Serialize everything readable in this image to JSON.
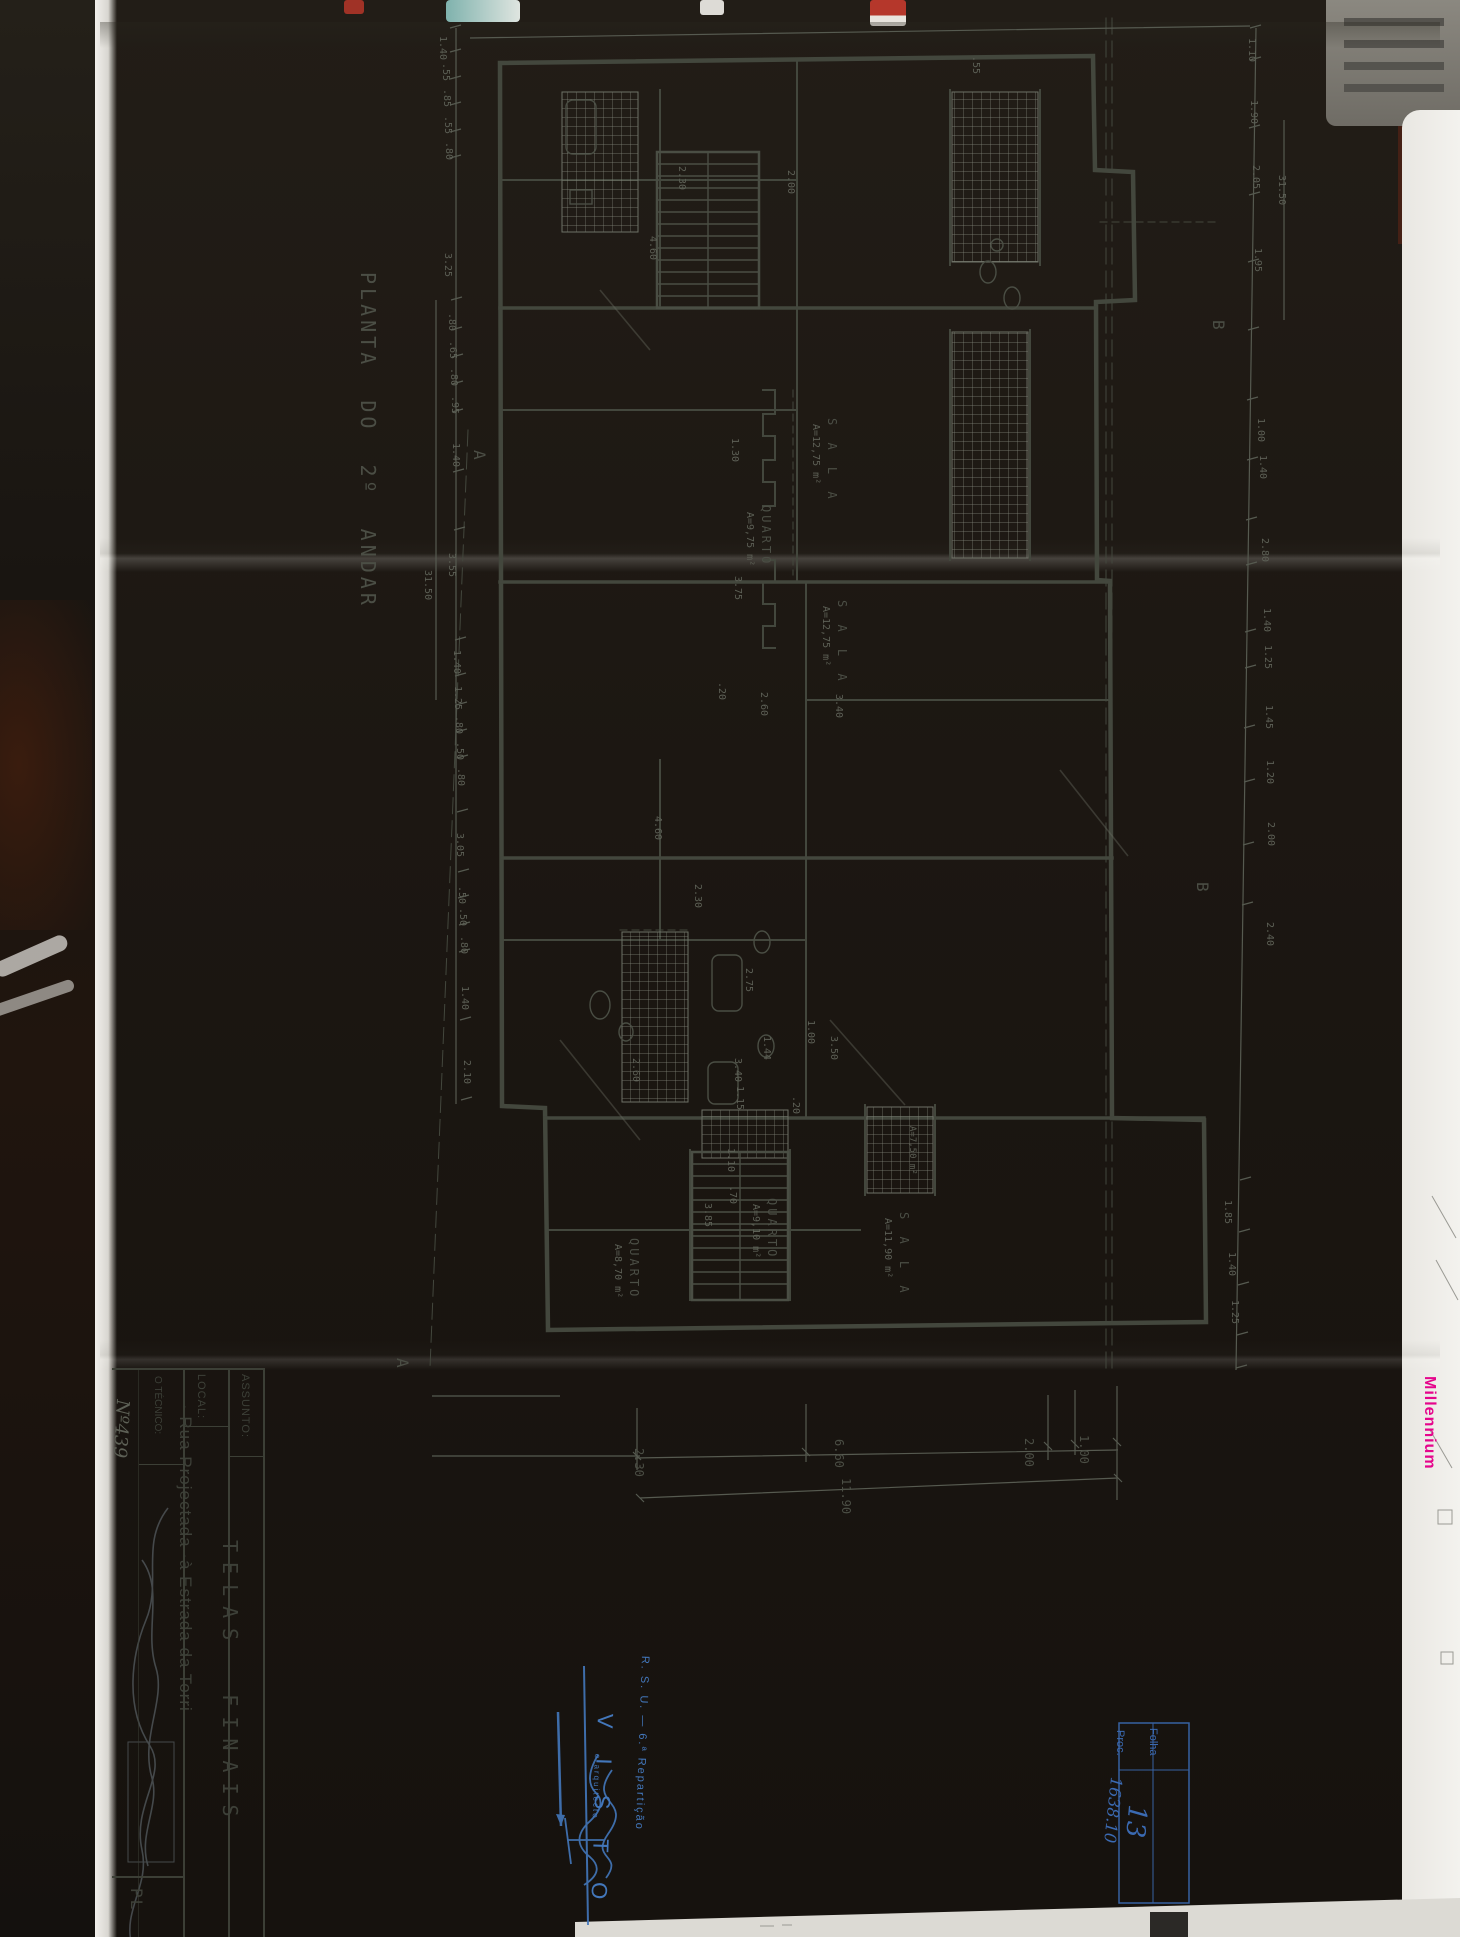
{
  "photo": {
    "description": "photograph of folded blueprint on dark table"
  },
  "drawing": {
    "title": "PLANTA  DO  2º  ANDAR",
    "sheet_subject": "TELAS FINAIS",
    "location": "Rua Projectada à Estrada da Torri",
    "floor_total_dim": "31.50"
  },
  "title_block": {
    "assunto_label": "ASSUNTO:",
    "assunto_value": "T E L A S   F I N A I S",
    "local_label": "LOCAL:",
    "local_value": "Rua Projectada ·à Estrada da Torri",
    "tecnico_label": "O TÉCNICO:",
    "tecnico_number": "Nº439",
    "corner_label": "PL"
  },
  "visto_stamp": {
    "dept": "R. S. U. — 6.ª Repartição",
    "visto": "V I S T O",
    "signer": "o arquitecto"
  },
  "folha_box": {
    "folha_label": "Folha",
    "folha_value": "13",
    "proc_label": "Proc.",
    "proc_value": "1638.10"
  },
  "side_text": {
    "brand": "Millennium"
  },
  "colors": {
    "paper": "#b3b0a4",
    "pencil": "#4b4e45",
    "wall": "#3d4038",
    "stamp_blue": "#4377bb",
    "brand_pink": "#e5058c"
  },
  "labels": [
    {
      "n": "drawing-title",
      "t": "PLANTA  DO  2º  ANDAR",
      "x": 378,
      "y": 272,
      "s": 20,
      "ls": 4,
      "c": "pencil"
    },
    {
      "n": "section-mark-a",
      "t": "A",
      "x": 487,
      "y": 450,
      "s": 16,
      "c": "pencil"
    },
    {
      "n": "section-mark-a",
      "t": "A",
      "x": 410,
      "y": 1358,
      "s": 16,
      "c": "pencil"
    },
    {
      "n": "section-mark-b",
      "t": "B",
      "x": 1226,
      "y": 320,
      "s": 16,
      "c": "pencil"
    },
    {
      "n": "section-mark-b",
      "t": "B",
      "x": 1210,
      "y": 882,
      "s": 16,
      "c": "pencil"
    },
    {
      "n": "room-name",
      "t": "S A L A",
      "x": 838,
      "y": 418,
      "s": 12,
      "ls": 5,
      "c": "pencil"
    },
    {
      "n": "room-area",
      "t": "A=12,75 m²",
      "x": 820,
      "y": 424,
      "s": 10,
      "c": "pencil2"
    },
    {
      "n": "room-name",
      "t": "QUARTO",
      "x": 772,
      "y": 505,
      "s": 12,
      "ls": 3,
      "c": "pencil"
    },
    {
      "n": "room-area",
      "t": "A=9,75 m²",
      "x": 754,
      "y": 512,
      "s": 10,
      "c": "pencil2"
    },
    {
      "n": "room-name",
      "t": "S A L A",
      "x": 848,
      "y": 600,
      "s": 12,
      "ls": 5,
      "c": "pencil"
    },
    {
      "n": "room-area",
      "t": "A=12,75 m²",
      "x": 830,
      "y": 606,
      "s": 10,
      "c": "pencil2"
    },
    {
      "n": "room-name",
      "t": "QUARTO",
      "x": 640,
      "y": 1238,
      "s": 12,
      "ls": 3,
      "c": "pencil"
    },
    {
      "n": "room-area",
      "t": "A=8,70 m²",
      "x": 622,
      "y": 1244,
      "s": 10,
      "c": "pencil2"
    },
    {
      "n": "room-name",
      "t": "QUARTO",
      "x": 778,
      "y": 1198,
      "s": 12,
      "ls": 3,
      "c": "pencil"
    },
    {
      "n": "room-area",
      "t": "A=9,10 m²",
      "x": 760,
      "y": 1204,
      "s": 10,
      "c": "pencil2"
    },
    {
      "n": "room-name",
      "t": "S A L A",
      "x": 910,
      "y": 1212,
      "s": 12,
      "ls": 5,
      "c": "pencil"
    },
    {
      "n": "room-area",
      "t": "A=11,90 m²",
      "x": 892,
      "y": 1218,
      "s": 10,
      "c": "pencil2"
    },
    {
      "n": "room-area",
      "t": "A=7,50 m²",
      "x": 916,
      "y": 1126,
      "s": 9,
      "c": "pencil2"
    },
    {
      "n": "dimension-label",
      "t": "1.40",
      "x": 447,
      "y": 36,
      "c": "pencil2"
    },
    {
      "n": "dimension-label",
      "t": ".55",
      "x": 450,
      "y": 63,
      "c": "pencil2"
    },
    {
      "n": "dimension-label",
      "t": ".85",
      "x": 451,
      "y": 89,
      "c": "pencil2"
    },
    {
      "n": "dimension-label",
      "t": ".55",
      "x": 452,
      "y": 116,
      "c": "pencil2"
    },
    {
      "n": "dimension-label",
      "t": ".80",
      "x": 453,
      "y": 142,
      "c": "pencil2"
    },
    {
      "n": "dimension-label",
      "t": "3.25",
      "x": 452,
      "y": 253,
      "c": "pencil2"
    },
    {
      "n": "dimension-label",
      "t": ".80",
      "x": 456,
      "y": 313,
      "c": "pencil2"
    },
    {
      "n": "dimension-label",
      "t": ".65",
      "x": 457,
      "y": 341,
      "c": "pencil2"
    },
    {
      "n": "dimension-label",
      "t": ".80",
      "x": 458,
      "y": 368,
      "c": "pencil2"
    },
    {
      "n": "dimension-label",
      "t": ".95",
      "x": 459,
      "y": 396,
      "c": "pencil2"
    },
    {
      "n": "dimension-label",
      "t": "1.40",
      "x": 460,
      "y": 443,
      "c": "pencil2"
    },
    {
      "n": "dimension-label",
      "t": "3.55",
      "x": 456,
      "y": 553,
      "c": "pencil2"
    },
    {
      "n": "dimension-label",
      "t": "31.50",
      "x": 432,
      "y": 570,
      "c": "pencil2"
    },
    {
      "n": "dimension-label",
      "t": "1.40",
      "x": 461,
      "y": 650,
      "c": "pencil2"
    },
    {
      "n": "dimension-label",
      "t": "1.25",
      "x": 462,
      "y": 686,
      "c": "pencil2"
    },
    {
      "n": "dimension-label",
      "t": ".80",
      "x": 463,
      "y": 716,
      "c": "pencil2"
    },
    {
      "n": "dimension-label",
      "t": ".50",
      "x": 464,
      "y": 742,
      "c": "pencil2"
    },
    {
      "n": "dimension-label",
      "t": ".80",
      "x": 465,
      "y": 768,
      "c": "pencil2"
    },
    {
      "n": "dimension-label",
      "t": "3.05",
      "x": 464,
      "y": 833,
      "c": "pencil2"
    },
    {
      "n": "dimension-label",
      "t": ".50",
      "x": 466,
      "y": 886,
      "c": "pencil2"
    },
    {
      "n": "dimension-label",
      "t": ".50",
      "x": 467,
      "y": 908,
      "c": "pencil2"
    },
    {
      "n": "dimension-label",
      "t": ".80",
      "x": 468,
      "y": 936,
      "c": "pencil2"
    },
    {
      "n": "dimension-label",
      "t": "1.40",
      "x": 469,
      "y": 986,
      "c": "pencil2"
    },
    {
      "n": "dimension-label",
      "t": "2.10",
      "x": 471,
      "y": 1060,
      "c": "pencil2"
    },
    {
      "n": "dimension-label",
      "t": "1.10",
      "x": 1256,
      "y": 38,
      "c": "pencil2"
    },
    {
      "n": "dimension-label",
      "t": "1.90",
      "x": 1258,
      "y": 100,
      "c": "pencil2"
    },
    {
      "n": "dimension-label",
      "t": "2.05",
      "x": 1260,
      "y": 165,
      "c": "pencil2"
    },
    {
      "n": "dimension-label",
      "t": "1.95",
      "x": 1262,
      "y": 248,
      "c": "pencil2"
    },
    {
      "n": "dimension-label",
      "t": "31.50",
      "x": 1286,
      "y": 175,
      "c": "pencil2"
    },
    {
      "n": "dimension-label",
      "t": "1.00",
      "x": 1265,
      "y": 418,
      "c": "pencil2"
    },
    {
      "n": "dimension-label",
      "t": "1.40",
      "x": 1267,
      "y": 455,
      "c": "pencil2"
    },
    {
      "n": "dimension-label",
      "t": "2.80",
      "x": 1269,
      "y": 538,
      "c": "pencil2"
    },
    {
      "n": "dimension-label",
      "t": "1.40",
      "x": 1271,
      "y": 608,
      "c": "pencil2"
    },
    {
      "n": "dimension-label",
      "t": "1.25",
      "x": 1272,
      "y": 645,
      "c": "pencil2"
    },
    {
      "n": "dimension-label",
      "t": "1.45",
      "x": 1273,
      "y": 705,
      "c": "pencil2"
    },
    {
      "n": "dimension-label",
      "t": "1.20",
      "x": 1274,
      "y": 760,
      "c": "pencil2"
    },
    {
      "n": "dimension-label",
      "t": "2.00",
      "x": 1275,
      "y": 822,
      "c": "pencil2"
    },
    {
      "n": "dimension-label",
      "t": "2.40",
      "x": 1274,
      "y": 922,
      "c": "pencil2"
    },
    {
      "n": "dimension-label",
      "t": "1.85",
      "x": 1232,
      "y": 1200,
      "c": "pencil2"
    },
    {
      "n": "dimension-label",
      "t": "1.40",
      "x": 1236,
      "y": 1252,
      "c": "pencil2"
    },
    {
      "n": "dimension-label",
      "t": "1.25",
      "x": 1239,
      "y": 1300,
      "c": "pencil2"
    },
    {
      "n": "dimension-label",
      "t": "2.30",
      "x": 686,
      "y": 166,
      "c": "pencil2"
    },
    {
      "n": "dimension-label",
      "t": "4.60",
      "x": 657,
      "y": 236,
      "c": "pencil2"
    },
    {
      "n": "dimension-label",
      "t": "2.00",
      "x": 795,
      "y": 170,
      "c": "pencil2"
    },
    {
      "n": "dimension-label",
      "t": ".55",
      "x": 980,
      "y": 56,
      "c": "pencil2"
    },
    {
      "n": "dimension-label",
      "t": "1.30",
      "x": 739,
      "y": 438,
      "c": "pencil2"
    },
    {
      "n": "dimension-label",
      "t": "3.75",
      "x": 742,
      "y": 576,
      "c": "pencil2"
    },
    {
      "n": "dimension-label",
      "t": ".20",
      "x": 726,
      "y": 682,
      "c": "pencil2"
    },
    {
      "n": "dimension-label",
      "t": "2.60",
      "x": 768,
      "y": 692,
      "c": "pencil2"
    },
    {
      "n": "dimension-label",
      "t": "3.40",
      "x": 843,
      "y": 694,
      "c": "pencil2"
    },
    {
      "n": "dimension-label",
      "t": "4.60",
      "x": 662,
      "y": 816,
      "c": "pencil2"
    },
    {
      "n": "dimension-label",
      "t": "2.30",
      "x": 702,
      "y": 884,
      "c": "pencil2"
    },
    {
      "n": "dimension-label",
      "t": "2.75",
      "x": 753,
      "y": 968,
      "c": "pencil2"
    },
    {
      "n": "dimension-label",
      "t": "1.44",
      "x": 771,
      "y": 1036,
      "c": "pencil2"
    },
    {
      "n": "dimension-label",
      "t": "1.15",
      "x": 744,
      "y": 1086,
      "c": "pencil2"
    },
    {
      "n": "dimension-label",
      "t": "1.00",
      "x": 815,
      "y": 1020,
      "c": "pencil2"
    },
    {
      "n": "dimension-label",
      "t": ".20",
      "x": 800,
      "y": 1096,
      "c": "pencil2"
    },
    {
      "n": "dimension-label",
      "t": "1.10",
      "x": 735,
      "y": 1148,
      "c": "pencil2"
    },
    {
      "n": "dimension-label",
      "t": ".70",
      "x": 737,
      "y": 1186,
      "c": "pencil2"
    },
    {
      "n": "dimension-label",
      "t": "2.60",
      "x": 640,
      "y": 1058,
      "c": "pencil2"
    },
    {
      "n": "dimension-label",
      "t": "3.40",
      "x": 742,
      "y": 1058,
      "c": "pencil2"
    },
    {
      "n": "dimension-label",
      "t": "3.50",
      "x": 838,
      "y": 1036,
      "c": "pencil2"
    },
    {
      "n": "dimension-label",
      "t": "3.85",
      "x": 712,
      "y": 1203,
      "c": "pencil2"
    },
    {
      "n": "dimension-label",
      "t": "2.30",
      "x": 645,
      "y": 1448,
      "s": 12,
      "c": "pencil"
    },
    {
      "n": "dimension-label",
      "t": "6.60",
      "x": 845,
      "y": 1439,
      "s": 12,
      "c": "pencil"
    },
    {
      "n": "dimension-label",
      "t": "2.00",
      "x": 1035,
      "y": 1438,
      "s": 12,
      "c": "pencil"
    },
    {
      "n": "dimension-label",
      "t": "1.00",
      "x": 1090,
      "y": 1435,
      "s": 12,
      "c": "pencil"
    },
    {
      "n": "dimension-label",
      "t": "11.90",
      "x": 852,
      "y": 1478,
      "s": 12,
      "c": "pencil"
    },
    {
      "n": "title-block-assunto-label",
      "t": "ASSUNTO:",
      "x": 250,
      "y": 1374,
      "s": 11,
      "ls": 1,
      "c": "dark",
      "f": "s"
    },
    {
      "n": "title-block-assunto-value",
      "t": "TELAS  FINAIS",
      "x": 240,
      "y": 1540,
      "s": 20,
      "ls": 10,
      "c": "dark"
    },
    {
      "n": "title-block-local-label",
      "t": "LOCAL:",
      "x": 206,
      "y": 1374,
      "s": 11,
      "ls": 1,
      "c": "dark",
      "f": "s"
    },
    {
      "n": "title-block-local-value",
      "t": "· Rua Projectada ·à Estrada da Torri",
      "x": 194,
      "y": 1404,
      "s": 17,
      "ls": 1,
      "c": "dark",
      "f": "s"
    },
    {
      "n": "title-block-tecnico-label",
      "t": "O TÉCNICO:",
      "x": 162,
      "y": 1376,
      "s": 10,
      "c": "dark",
      "f": "s"
    },
    {
      "n": "title-block-tecnico-number",
      "t": "Nº439",
      "x": 131,
      "y": 1400,
      "s": 18,
      "r": 93,
      "c": "pencil2",
      "f": "i"
    },
    {
      "n": "title-block-corner-label",
      "t": "PL",
      "x": 144,
      "y": 1888,
      "s": 16,
      "ls": 2,
      "c": "dark"
    },
    {
      "n": "stamp-dept",
      "t": "R. S. U. — 6.ª Repartição",
      "x": 650,
      "y": 1656,
      "s": 11,
      "ls": 2,
      "r": 92,
      "c": "blue",
      "f": "s"
    },
    {
      "n": "stamp-visto",
      "t": "V I S T O",
      "x": 616,
      "y": 1714,
      "s": 22,
      "ls": 12,
      "r": 92,
      "c": "blue",
      "f": "s"
    },
    {
      "n": "stamp-signer",
      "t": "o arquitecto",
      "x": 601,
      "y": 1754,
      "s": 8,
      "ls": 2,
      "r": 92,
      "c": "blue",
      "f": "s"
    },
    {
      "n": "folha-box-folha-label",
      "t": "Folha",
      "x": 1158,
      "y": 1728,
      "s": 11,
      "c": "blue2",
      "f": "s"
    },
    {
      "n": "folha-box-proc-label",
      "t": "Proc.",
      "x": 1125,
      "y": 1730,
      "s": 11,
      "c": "blue2",
      "f": "s"
    },
    {
      "n": "folha-box-folha-value",
      "t": "13",
      "x": 1150,
      "y": 1806,
      "s": 26,
      "r": 95,
      "c": "blue2",
      "f": "i"
    },
    {
      "n": "folha-box-proc-value",
      "t": "1638.10",
      "x": 1124,
      "y": 1778,
      "s": 16,
      "r": 96,
      "c": "blue2",
      "f": "i"
    },
    {
      "n": "brand-text",
      "t": "Millennium",
      "x": 1437,
      "y": 1376,
      "s": 16,
      "ls": 1,
      "c": "pink",
      "f": "s b"
    }
  ]
}
